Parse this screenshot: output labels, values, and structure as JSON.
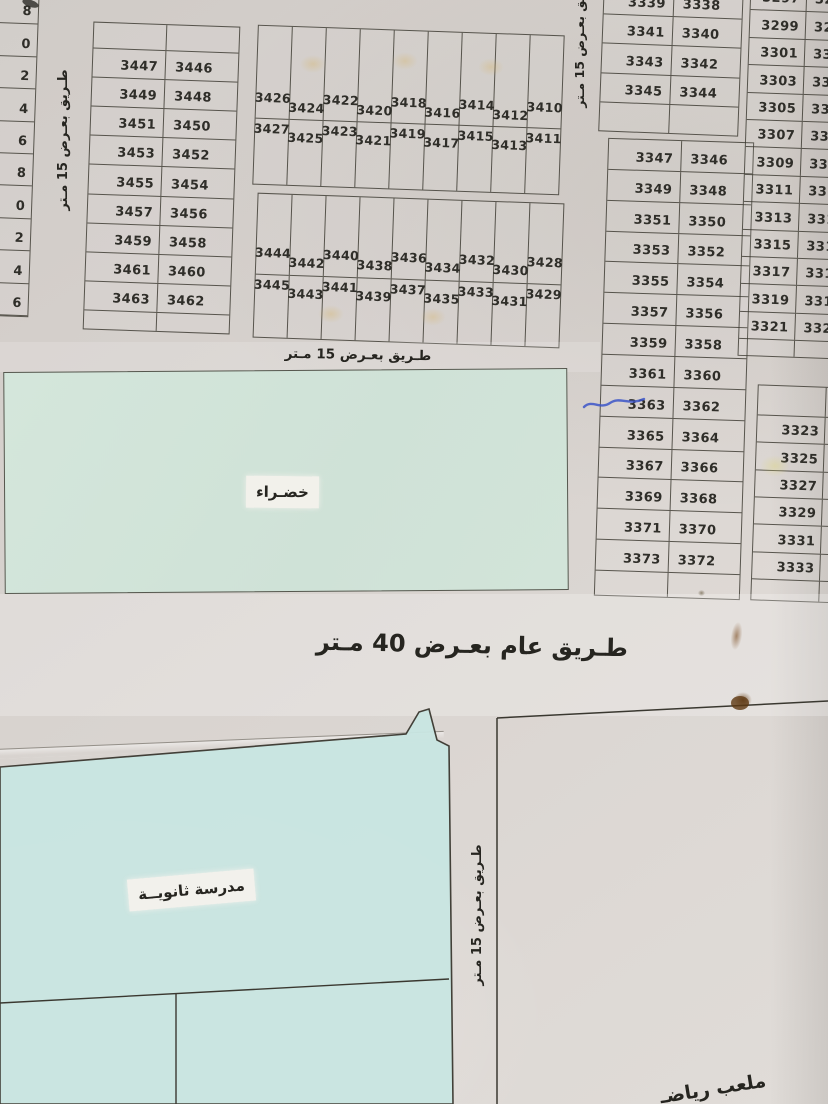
{
  "labels": {
    "road_15_vertical_left": "طـريق بعـرض 15 مـتر",
    "road_15_vertical_mid": "طريق بعـرض 15 مـتر",
    "road_15_horizontal": "طـريق بعـرض 15 مـتر",
    "road_15_vertical_right": "طـريق بعـرض 15 مـتر",
    "road_40_main": "طـريق عام بعـرض 40 مـتر",
    "green_area": "خضـراء",
    "school": "مدرسة ثانويــة",
    "sports_field_partial": "ملعب رياضـ"
  },
  "colors": {
    "green_area": "#d2e4d9",
    "school_area": "#c9e6e2",
    "pen_mark": "#3c55c8",
    "stain_brown": "#7a4a1e",
    "line": "#3a3830"
  },
  "blocks": {
    "left_edge": {
      "digits": [
        "8",
        "0",
        "2",
        "4",
        "6",
        "8",
        "0",
        "2",
        "4",
        "6"
      ]
    },
    "west": {
      "rows": [
        [
          "3447",
          "3446"
        ],
        [
          "3449",
          "3448"
        ],
        [
          "3451",
          "3450"
        ],
        [
          "3453",
          "3452"
        ],
        [
          "3455",
          "3454"
        ],
        [
          "3457",
          "3456"
        ],
        [
          "3459",
          "3458"
        ],
        [
          "3461",
          "3460"
        ],
        [
          "3463",
          "3462"
        ]
      ]
    },
    "north_strips": {
      "columns": [
        [
          "3426",
          "3427"
        ],
        [
          "3424",
          "3425"
        ],
        [
          "3422",
          "3423"
        ],
        [
          "3420",
          "3421"
        ],
        [
          "3418",
          "3419"
        ],
        [
          "3416",
          "3417"
        ],
        [
          "3414",
          "3415"
        ],
        [
          "3412",
          "3413"
        ],
        [
          "3410",
          "3411"
        ]
      ]
    },
    "mid_strips": {
      "columns": [
        [
          "3444",
          "3445"
        ],
        [
          "3442",
          "3443"
        ],
        [
          "3440",
          "3441"
        ],
        [
          "3438",
          "3439"
        ],
        [
          "3436",
          "3437"
        ],
        [
          "3434",
          "3435"
        ],
        [
          "3432",
          "3433"
        ],
        [
          "3430",
          "3431"
        ],
        [
          "3428",
          "3429"
        ]
      ]
    },
    "northeast": {
      "rows": [
        [
          "3339",
          "3338"
        ],
        [
          "3341",
          "3340"
        ],
        [
          "3343",
          "3342"
        ],
        [
          "3345",
          "3344"
        ]
      ]
    },
    "east": {
      "rows": [
        [
          "3347",
          "3346"
        ],
        [
          "3349",
          "3348"
        ],
        [
          "3351",
          "3350"
        ],
        [
          "3353",
          "3352"
        ],
        [
          "3355",
          "3354"
        ],
        [
          "3357",
          "3356"
        ],
        [
          "3359",
          "3358"
        ],
        [
          "3361",
          "3360"
        ],
        [
          "3363",
          "3362"
        ],
        [
          "3365",
          "3364"
        ],
        [
          "3367",
          "3366"
        ],
        [
          "3369",
          "3368"
        ],
        [
          "3371",
          "3370"
        ],
        [
          "3373",
          "3372"
        ]
      ]
    },
    "far_east_upper": {
      "rows": [
        [
          "3297",
          "3296"
        ],
        [
          "3299",
          "3298"
        ],
        [
          "3301",
          "3300"
        ],
        [
          "3303",
          "3302"
        ],
        [
          "3305",
          "3304"
        ],
        [
          "3307",
          "3306"
        ],
        [
          "3309",
          "3308"
        ],
        [
          "3311",
          "3310"
        ],
        [
          "3313",
          "3312"
        ],
        [
          "3315",
          "3314"
        ],
        [
          "3317",
          "3316"
        ],
        [
          "3319",
          "3318"
        ],
        [
          "3321",
          "3320"
        ]
      ]
    },
    "far_east_lower": {
      "values": [
        "3323",
        "3325",
        "3327",
        "3329",
        "3331",
        "3333"
      ]
    }
  }
}
